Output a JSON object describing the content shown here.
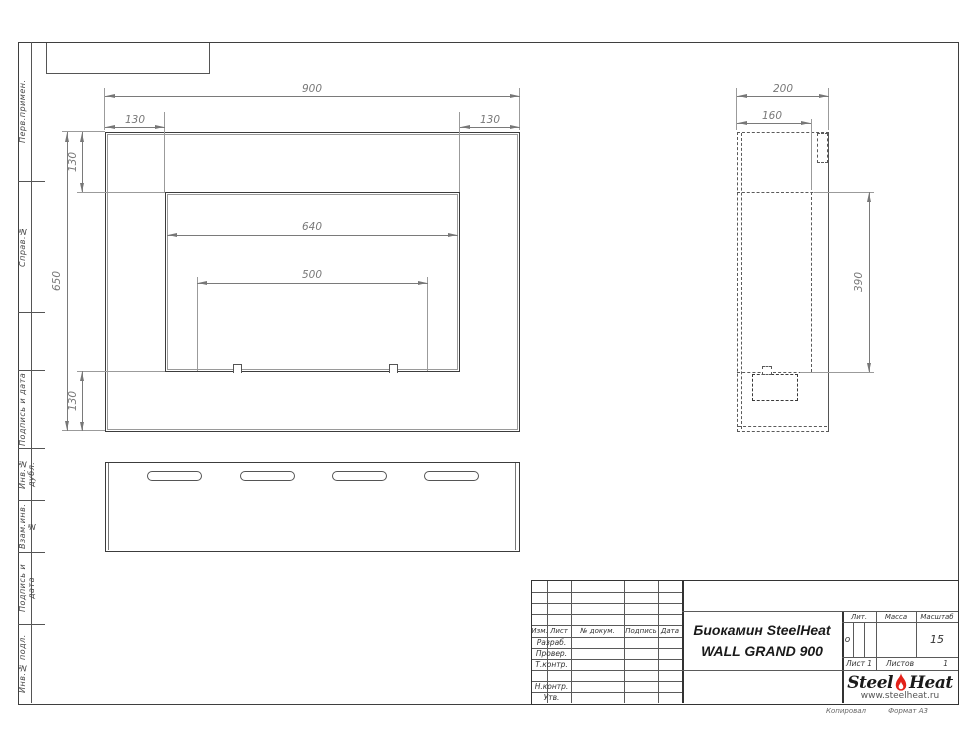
{
  "left_strip": {
    "labels": [
      "Перв.примен.",
      "Справ.№",
      "Подпись и дата",
      "Инв.№ дубл.",
      "Взам.инв.№",
      "Подпись и дата",
      "Инв.№ подл."
    ]
  },
  "dims": {
    "front": {
      "overall_width": "900",
      "margin_left": "130",
      "margin_right": "130",
      "overall_height": "650",
      "margin_top": "130",
      "margin_bottom": "130",
      "opening_width": "640",
      "burner_width": "500"
    },
    "side": {
      "depth": "200",
      "inner_depth": "160",
      "opening_height": "390"
    }
  },
  "title_block": {
    "header_cols": [
      "Изм.",
      "Лист",
      "№ докум.",
      "Подпись",
      "Дата"
    ],
    "roles": [
      "Разраб.",
      "Провер.",
      "Т.контр.",
      "",
      "Н.контр.",
      "Утв."
    ],
    "product_title_1": "Биокамин SteelHeat",
    "product_title_2": "WALL GRAND 900",
    "lit": {
      "label": "Лит.",
      "value": "о"
    },
    "mass": {
      "label": "Масса",
      "value": ""
    },
    "scale": {
      "label": "Масштаб",
      "value": "15"
    },
    "sheet": {
      "label": "Лист",
      "value": "1"
    },
    "sheets": {
      "label": "Листов",
      "value": "1"
    }
  },
  "logo": {
    "part1": "Steel",
    "part2": "Heat",
    "url": "www.steelheat.ru",
    "flame_color": "#e32119"
  },
  "footer": {
    "copied": "Копировал",
    "format": "Формат А3"
  }
}
